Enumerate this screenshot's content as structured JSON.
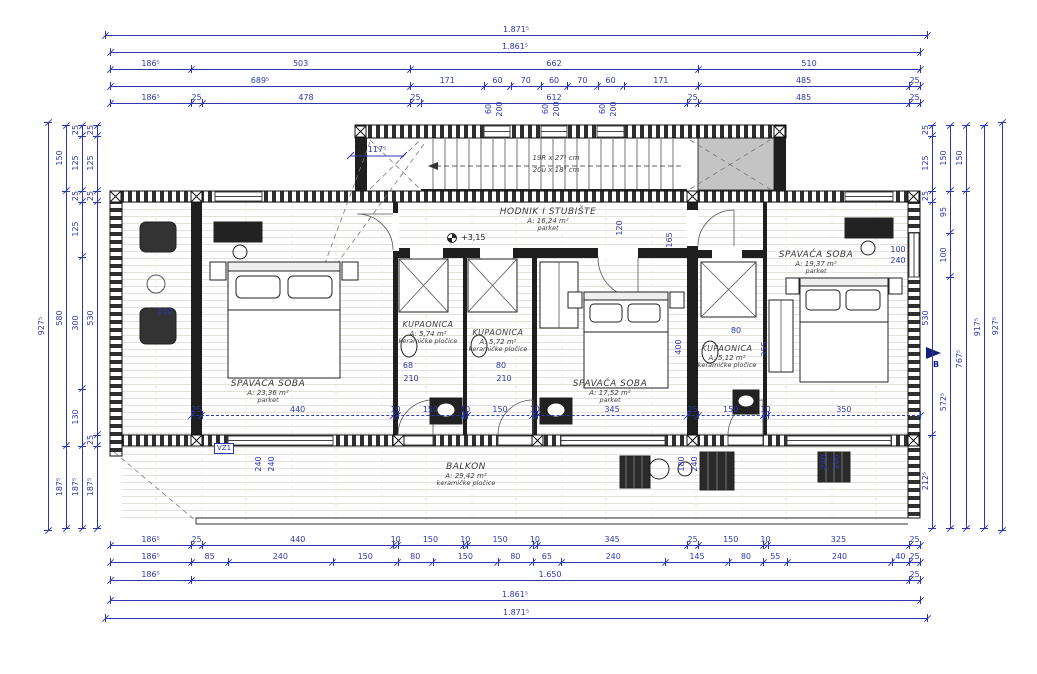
{
  "drawing": {
    "rooms": [
      {
        "name": "SPAVAĆA SOBA",
        "area": "A: 23,36 m²",
        "floor": "parket",
        "x": 268,
        "y": 379,
        "size": "big"
      },
      {
        "name": "KUPAONICA",
        "area": "A: 5,74 m²",
        "floor": "keramičke pločice",
        "x": 428,
        "y": 320,
        "size": "small"
      },
      {
        "name": "KUPAONICA",
        "area": "A: 5,72 m²",
        "floor": "keramičke pločice",
        "x": 498,
        "y": 328,
        "size": "small"
      },
      {
        "name": "HODNIK I STUBIŠTE",
        "area": "A: 16,24 m²",
        "floor": "parket",
        "x": 548,
        "y": 207,
        "size": "big"
      },
      {
        "name": "SPAVAĆA SOBA",
        "area": "A: 17,52 m²",
        "floor": "parket",
        "x": 610,
        "y": 379,
        "size": "big"
      },
      {
        "name": "KUPAONICA",
        "area": "A: 5,12 m²",
        "floor": "keramičke pločice",
        "x": 727,
        "y": 344,
        "size": "small"
      },
      {
        "name": "SPAVAĆA SOBA",
        "area": "A: 19,37 m²",
        "floor": "parket",
        "x": 816,
        "y": 250,
        "size": "big"
      },
      {
        "name": "BALKON",
        "area": "A: 29,42 m²",
        "floor": "keramičke pločice",
        "x": 466,
        "y": 462,
        "size": "big"
      }
    ],
    "stair_note_1": "19R x 27⁵ cm",
    "stair_note_2": "20u x 18⁵ cm",
    "level_marker": "+3,15",
    "section_label": "B",
    "wall_tag": "VZ1",
    "colors": {
      "dim": "#2e38ad",
      "wall": "#1f1f1f",
      "grey_fill": "#c4c4c4"
    }
  },
  "chains": [
    {
      "side": "top",
      "pos": 35,
      "start": 105,
      "end": 927,
      "segs": [
        [
          "1.871⁵",
          1871.5
        ]
      ]
    },
    {
      "side": "top",
      "pos": 52,
      "start": 110,
      "end": 920,
      "segs": [
        [
          "1.861⁵",
          1861.5
        ]
      ]
    },
    {
      "side": "top",
      "pos": 69,
      "start": 110,
      "end": 920,
      "segs": [
        [
          "186⁵",
          186.5
        ],
        [
          "503",
          503
        ],
        [
          "662",
          662
        ],
        [
          "510",
          510
        ]
      ]
    },
    {
      "side": "top",
      "pos": 86,
      "start": 110,
      "end": 920,
      "segs": [
        [
          "689⁵",
          689.5
        ],
        [
          "171",
          171
        ],
        [
          "60",
          60
        ],
        [
          "70",
          70
        ],
        [
          "60",
          60
        ],
        [
          "70",
          70
        ],
        [
          "60",
          60
        ],
        [
          "171",
          171
        ],
        [
          "485",
          485
        ],
        [
          "25",
          25
        ]
      ]
    },
    {
      "side": "top",
      "pos": 103,
      "start": 110,
      "end": 920,
      "segs": [
        [
          "186⁵",
          186.5
        ],
        [
          "25",
          25
        ],
        [
          "478",
          478
        ],
        [
          "25",
          25
        ],
        [
          "612",
          612
        ],
        [
          "25",
          25
        ],
        [
          "485",
          485
        ],
        [
          "25",
          25
        ]
      ]
    },
    {
      "side": "top",
      "pos": 415,
      "start": 191,
      "end": 920,
      "dashed": true,
      "segs": [
        [
          "25",
          25
        ],
        [
          "440",
          440
        ],
        [
          "10",
          10
        ],
        [
          "150",
          150
        ],
        [
          "10",
          10
        ],
        [
          "150",
          150
        ],
        [
          "10",
          10
        ],
        [
          "345",
          345
        ],
        [
          "25",
          25
        ],
        [
          "150",
          150
        ],
        [
          "10",
          10
        ],
        [
          "350",
          350
        ]
      ]
    },
    {
      "side": "bottom",
      "pos": 545,
      "start": 110,
      "end": 920,
      "segs": [
        [
          "186⁵",
          186.5
        ],
        [
          "25",
          25
        ],
        [
          "440",
          440
        ],
        [
          "10",
          10
        ],
        [
          "150",
          150
        ],
        [
          "10",
          10
        ],
        [
          "150",
          150
        ],
        [
          "10",
          10
        ],
        [
          "345",
          345
        ],
        [
          "25",
          25
        ],
        [
          "150",
          150
        ],
        [
          "10",
          10
        ],
        [
          "325",
          325
        ],
        [
          "25",
          25
        ]
      ]
    },
    {
      "side": "bottom",
      "pos": 562,
      "start": 110,
      "end": 920,
      "segs": [
        [
          "186⁵",
          186.5
        ],
        [
          "85",
          85
        ],
        [
          "240",
          240
        ],
        [
          "150",
          150
        ],
        [
          "80",
          80
        ],
        [
          "150",
          150
        ],
        [
          "80",
          80
        ],
        [
          "65",
          65
        ],
        [
          "240",
          240
        ],
        [
          "145",
          145
        ],
        [
          "80",
          80
        ],
        [
          "55",
          55
        ],
        [
          "240",
          240
        ],
        [
          "40",
          40
        ],
        [
          "25",
          25
        ]
      ]
    },
    {
      "side": "bottom",
      "pos": 580,
      "start": 110,
      "end": 920,
      "segs": [
        [
          "186⁵",
          186.5
        ],
        [
          "1.650",
          1650
        ],
        [
          "25",
          25
        ]
      ]
    },
    {
      "side": "bottom",
      "pos": 600,
      "start": 110,
      "end": 920,
      "segs": [
        [
          "1.861⁵",
          1861.5
        ]
      ]
    },
    {
      "side": "bottom",
      "pos": 618,
      "start": 105,
      "end": 927,
      "segs": [
        [
          "1.871⁵",
          1871.5
        ]
      ]
    },
    {
      "side": "left",
      "pos": 48,
      "start": 122,
      "end": 530,
      "segs": [
        [
          "927⁵",
          927.5
        ]
      ]
    },
    {
      "side": "left",
      "pos": 66,
      "start": 125,
      "end": 528,
      "segs": [
        [
          "150",
          150
        ],
        [
          "580",
          580
        ],
        [
          "187⁵",
          187.5
        ]
      ]
    },
    {
      "side": "left",
      "pos": 82,
      "start": 125,
      "end": 528,
      "segs": [
        [
          "25",
          25
        ],
        [
          "125",
          125
        ],
        [
          "25",
          25
        ],
        [
          "125",
          125
        ],
        [
          "300",
          300
        ],
        [
          "130",
          130
        ],
        [
          "187⁵",
          187.5
        ]
      ]
    },
    {
      "side": "left",
      "pos": 97,
      "start": 125,
      "end": 528,
      "segs": [
        [
          "25",
          25
        ],
        [
          "125",
          125
        ],
        [
          "25",
          25
        ],
        [
          "530",
          530
        ],
        [
          "25",
          25
        ],
        [
          "187⁵",
          187.5
        ]
      ]
    },
    {
      "side": "right",
      "pos": 932,
      "start": 125,
      "end": 528,
      "segs": [
        [
          "25",
          25
        ],
        [
          "125",
          125
        ],
        [
          "25",
          25
        ],
        [
          "530",
          530
        ],
        [
          "212⁵",
          212.5
        ]
      ]
    },
    {
      "side": "right",
      "pos": 950,
      "start": 125,
      "end": 528,
      "segs": [
        [
          "150",
          150
        ],
        [
          "95",
          95
        ],
        [
          "100",
          100
        ],
        [
          "572⁵",
          572.5
        ]
      ]
    },
    {
      "side": "right",
      "pos": 966,
      "start": 125,
      "end": 528,
      "segs": [
        [
          "150",
          150
        ],
        [
          "767⁵",
          767.5
        ]
      ]
    },
    {
      "side": "right",
      "pos": 984,
      "start": 125,
      "end": 528,
      "segs": [
        [
          "917⁵",
          917.5
        ]
      ]
    },
    {
      "side": "right",
      "pos": 1002,
      "start": 122,
      "end": 530,
      "segs": [
        [
          "927⁵",
          927.5
        ]
      ]
    }
  ],
  "free_dims": [
    {
      "t": "117⁵",
      "x": 377,
      "y": 150,
      "r": 0
    },
    {
      "t": "60",
      "x": 489,
      "y": 109,
      "r": -90
    },
    {
      "t": "200",
      "x": 500,
      "y": 109,
      "r": -90
    },
    {
      "t": "60",
      "x": 546,
      "y": 109,
      "r": -90
    },
    {
      "t": "200",
      "x": 557,
      "y": 109,
      "r": -90
    },
    {
      "t": "60",
      "x": 603,
      "y": 109,
      "r": -90
    },
    {
      "t": "200",
      "x": 614,
      "y": 109,
      "r": -90
    },
    {
      "t": "120",
      "x": 620,
      "y": 228,
      "r": -90
    },
    {
      "t": "165",
      "x": 670,
      "y": 240,
      "r": -90
    },
    {
      "t": "100",
      "x": 165,
      "y": 312,
      "r": 0
    },
    {
      "t": "68",
      "x": 408,
      "y": 366,
      "r": 0
    },
    {
      "t": "210",
      "x": 411,
      "y": 379,
      "r": 0
    },
    {
      "t": "80",
      "x": 501,
      "y": 366,
      "r": 0
    },
    {
      "t": "210",
      "x": 504,
      "y": 379,
      "r": 0
    },
    {
      "t": "400",
      "x": 679,
      "y": 347,
      "r": -90
    },
    {
      "t": "80",
      "x": 736,
      "y": 331,
      "r": 0
    },
    {
      "t": "355",
      "x": 765,
      "y": 349,
      "r": -90
    },
    {
      "t": "100",
      "x": 898,
      "y": 250,
      "r": 0
    },
    {
      "t": "240",
      "x": 898,
      "y": 261,
      "r": 0
    },
    {
      "t": "240",
      "x": 259,
      "y": 464,
      "r": -90
    },
    {
      "t": "240",
      "x": 272,
      "y": 464,
      "r": -90
    },
    {
      "t": "180",
      "x": 682,
      "y": 464,
      "r": -90
    },
    {
      "t": "240",
      "x": 695,
      "y": 464,
      "r": -90
    },
    {
      "t": "240",
      "x": 824,
      "y": 462,
      "r": -90
    },
    {
      "t": "240",
      "x": 837,
      "y": 462,
      "r": -90
    }
  ]
}
